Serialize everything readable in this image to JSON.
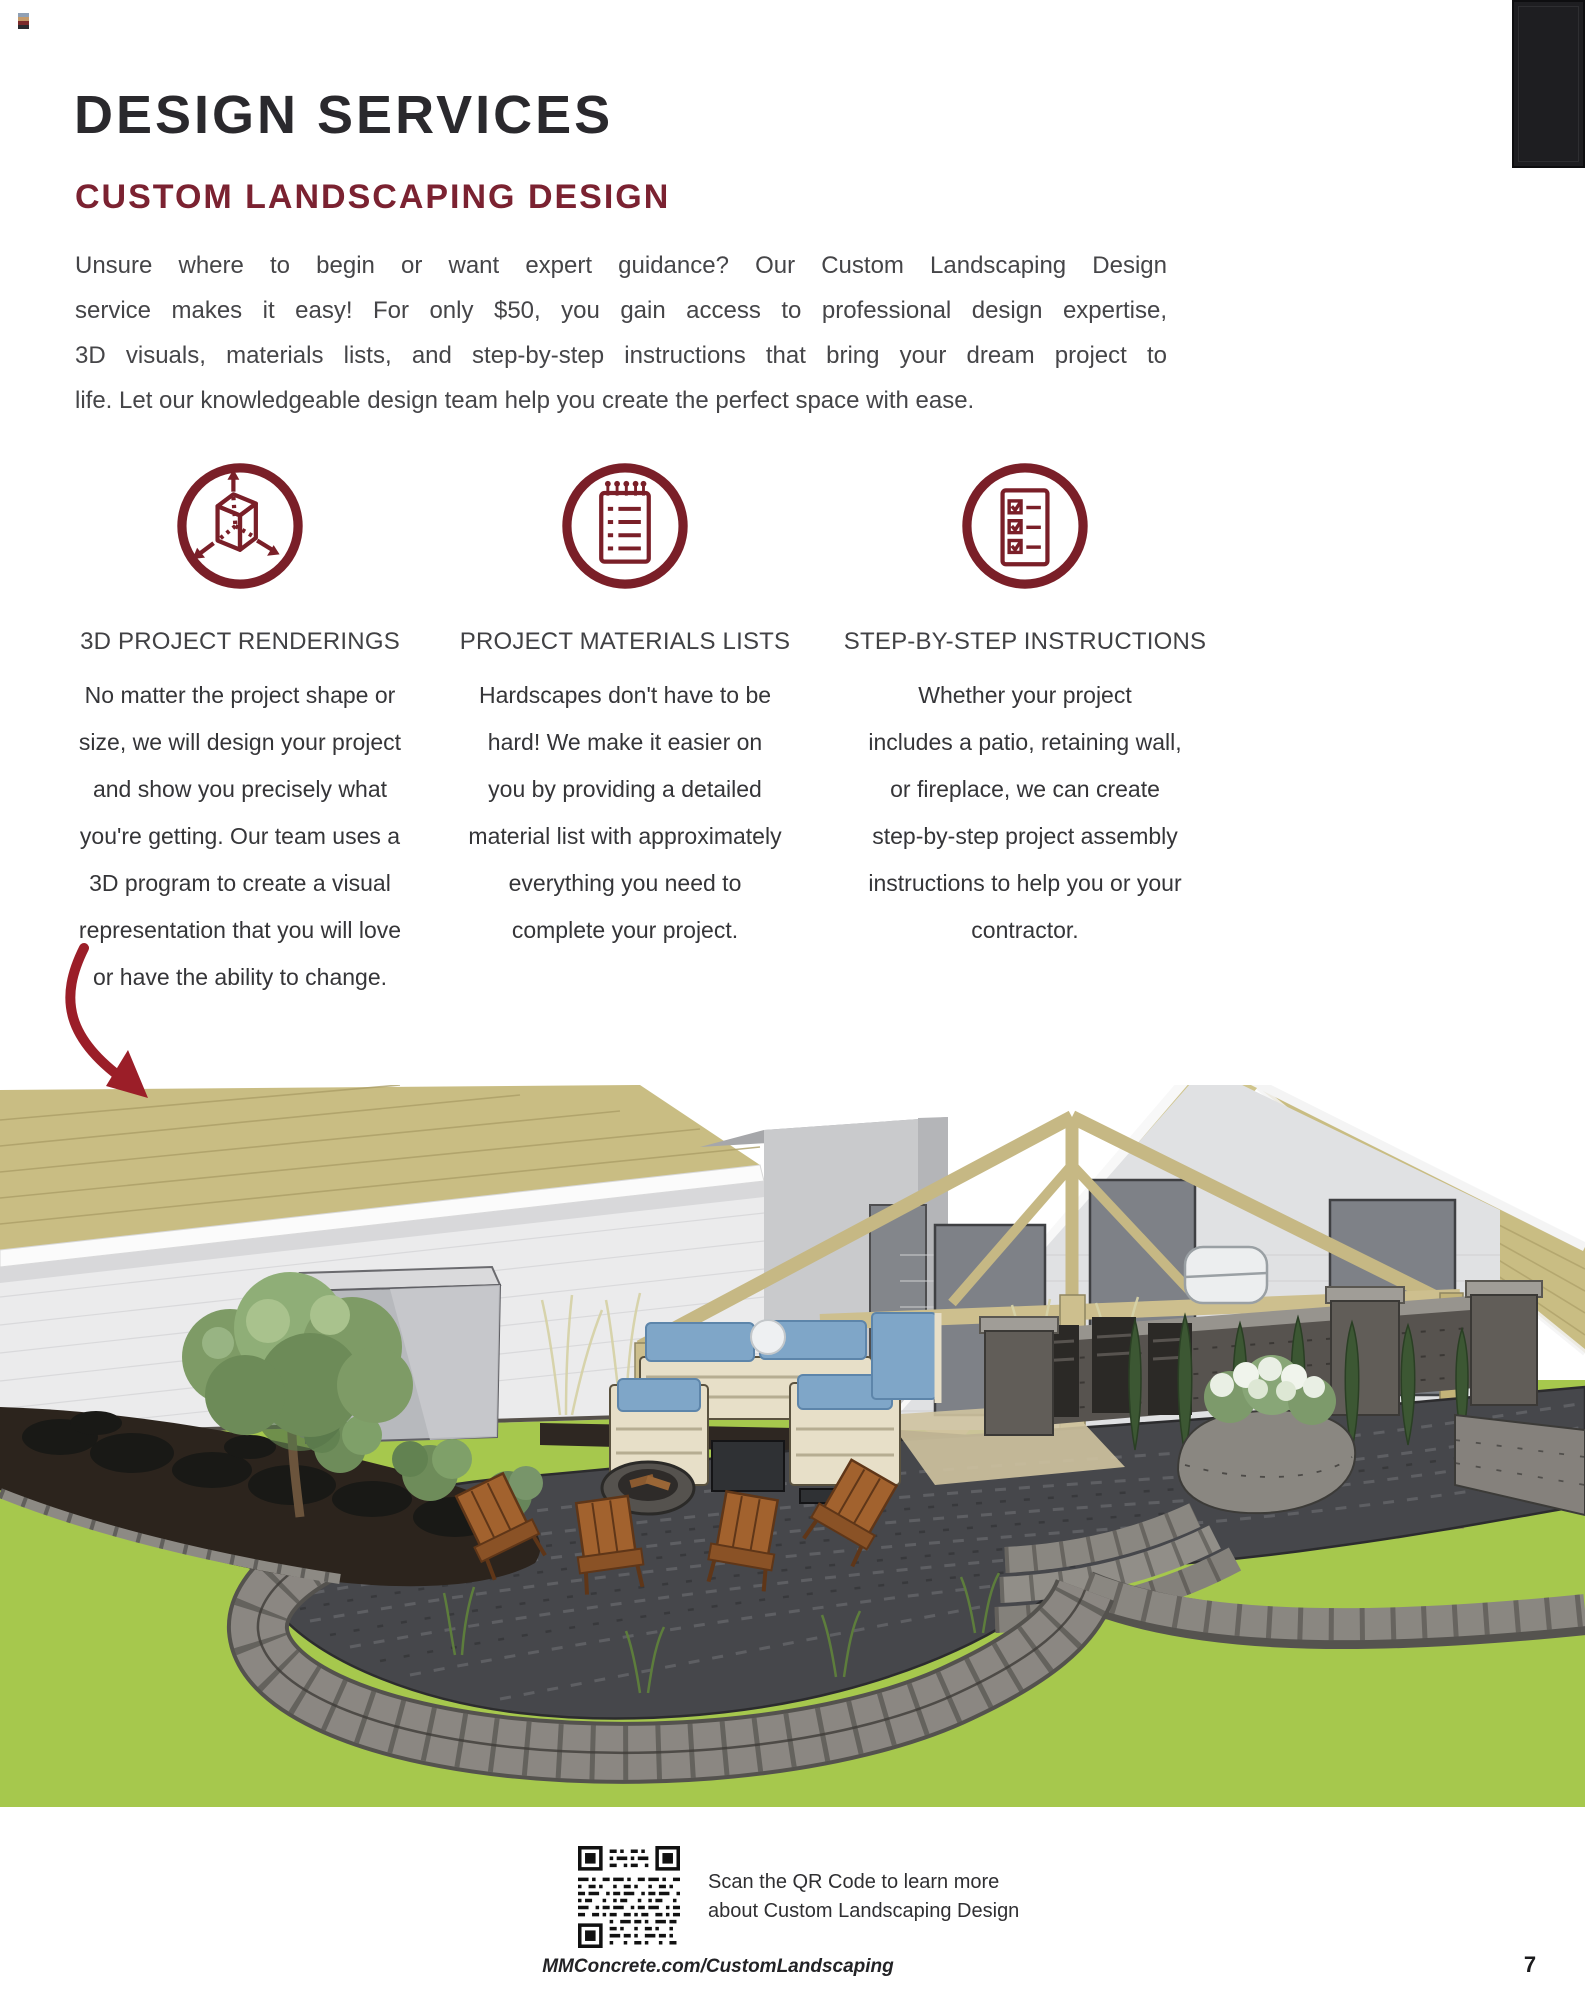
{
  "page": {
    "title": "DESIGN SERVICES",
    "subtitle": "CUSTOM LANDSCAPING DESIGN",
    "page_number": "7",
    "footer_url": "MMConcrete.com/CustomLandscaping"
  },
  "intro": {
    "line1": "Unsure where to begin or want expert guidance? Our Custom Landscaping Design",
    "line2": "service makes it easy! For only $50, you gain access to professional design expertise,",
    "line3": "3D visuals, materials lists, and step-by-step instructions that bring your dream project to",
    "line4": "life. Let our knowledgeable design team help you create the perfect space with ease."
  },
  "features": [
    {
      "icon": "3d-cube-icon",
      "heading": "3D PROJECT RENDERINGS",
      "lines": [
        "No matter the project shape or",
        "size, we will design your project",
        "and show you precisely what",
        "you're getting. Our team uses a",
        "3D program to create a visual",
        "representation that you will love",
        "or have the ability to change."
      ]
    },
    {
      "icon": "materials-list-icon",
      "heading": "PROJECT MATERIALS LISTS",
      "lines": [
        "Hardscapes don't have to be",
        "hard! We make it easier on",
        "you by providing a detailed",
        "material list with approximately",
        "everything you need to",
        "complete your project."
      ]
    },
    {
      "icon": "checklist-icon",
      "heading": "STEP-BY-STEP INSTRUCTIONS",
      "lines": [
        "Whether your project",
        "includes a patio, retaining wall,",
        "or fireplace, we can create",
        "step-by-step project assembly",
        "instructions to help you or your",
        "contractor."
      ]
    }
  ],
  "qr_section": {
    "line1": "Scan the QR Code to learn more",
    "line2": "about Custom Landscaping Design"
  },
  "rendering": {
    "caption": "3D rendering of a custom backyard design with patio, pergola, outdoor furniture, fire pit seating area and curved retaining walls"
  },
  "colors": {
    "maroon": "#7b2231",
    "arrow_red": "#9b1e28",
    "title_dark": "#2a292d",
    "body_text": "#3c3c3f",
    "lawn_green": "#a6c84d",
    "roof_tan": "#c9bd83"
  }
}
